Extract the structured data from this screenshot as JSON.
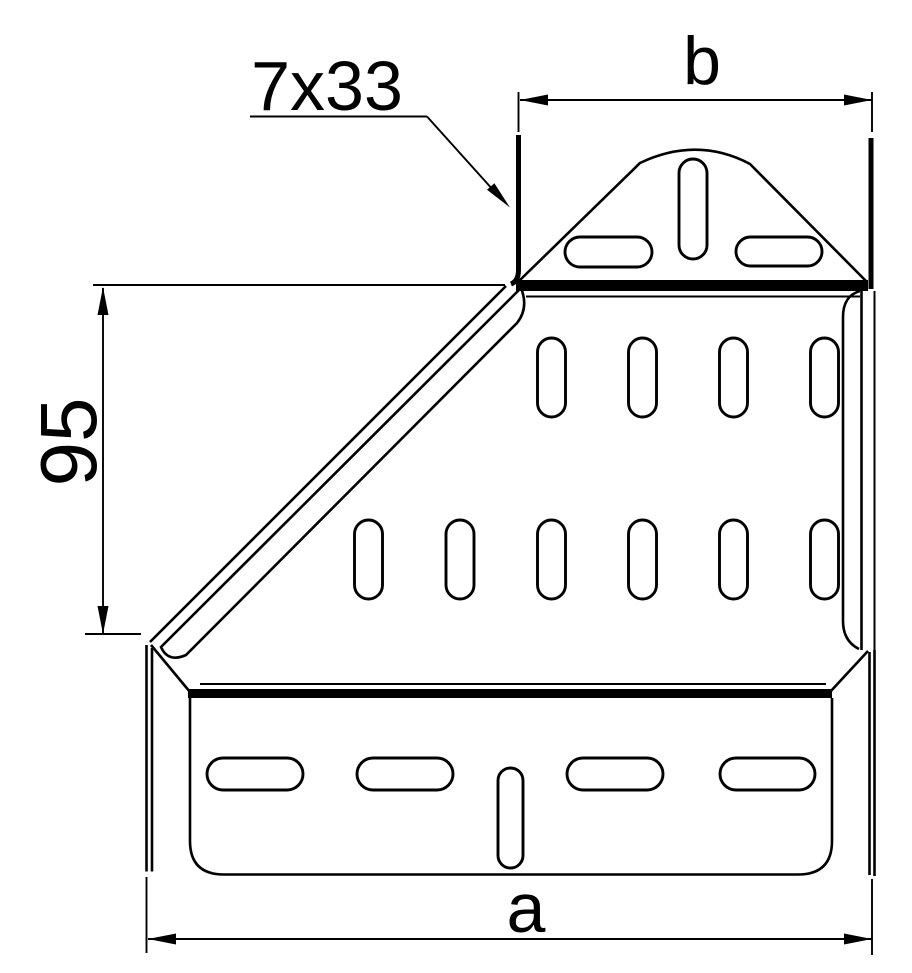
{
  "colors": {
    "line": "#000000",
    "background": "#ffffff"
  },
  "labels": {
    "slot_callout": "7x33",
    "top_width": "b",
    "left_height": "95",
    "bottom_width": "a"
  }
}
